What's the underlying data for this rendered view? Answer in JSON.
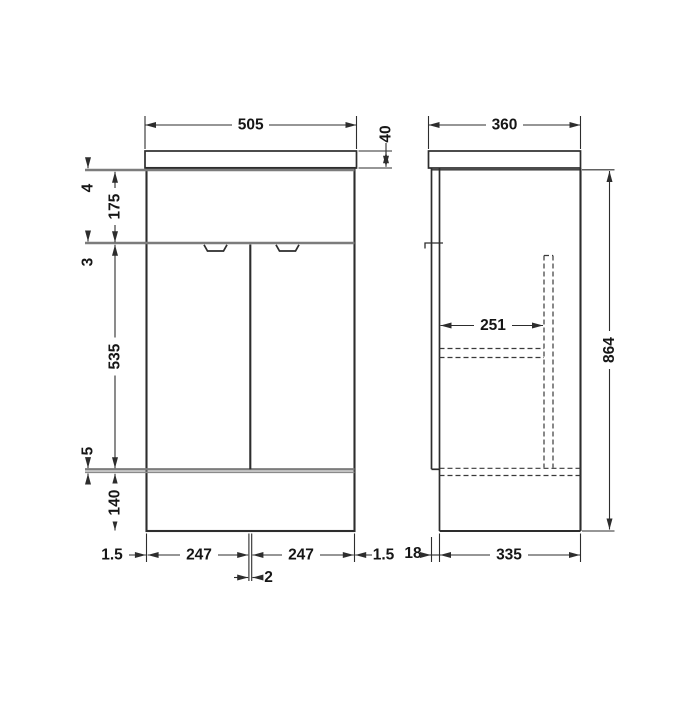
{
  "drawing": {
    "title": "Vanity unit technical drawing - front and side elevation",
    "colors": {
      "line": "#2d2d2d",
      "soft_line": "#7c7c7c",
      "background": "#ffffff",
      "text": "#161616"
    }
  },
  "front": {
    "width": "505",
    "counter_thickness": "40",
    "top_rail": "4",
    "panel_height": "175",
    "mid_rail": "3",
    "door_height": "535",
    "bottom_gap": "5",
    "plinth_height": "140",
    "side_panel_left": "1.5",
    "door_width_left": "247",
    "door_width_right": "247",
    "side_panel_right": "1.5",
    "door_gap": "2"
  },
  "side": {
    "depth": "360",
    "internal_depth": "251",
    "height": "864",
    "door_offset": "18",
    "body_depth": "335"
  }
}
